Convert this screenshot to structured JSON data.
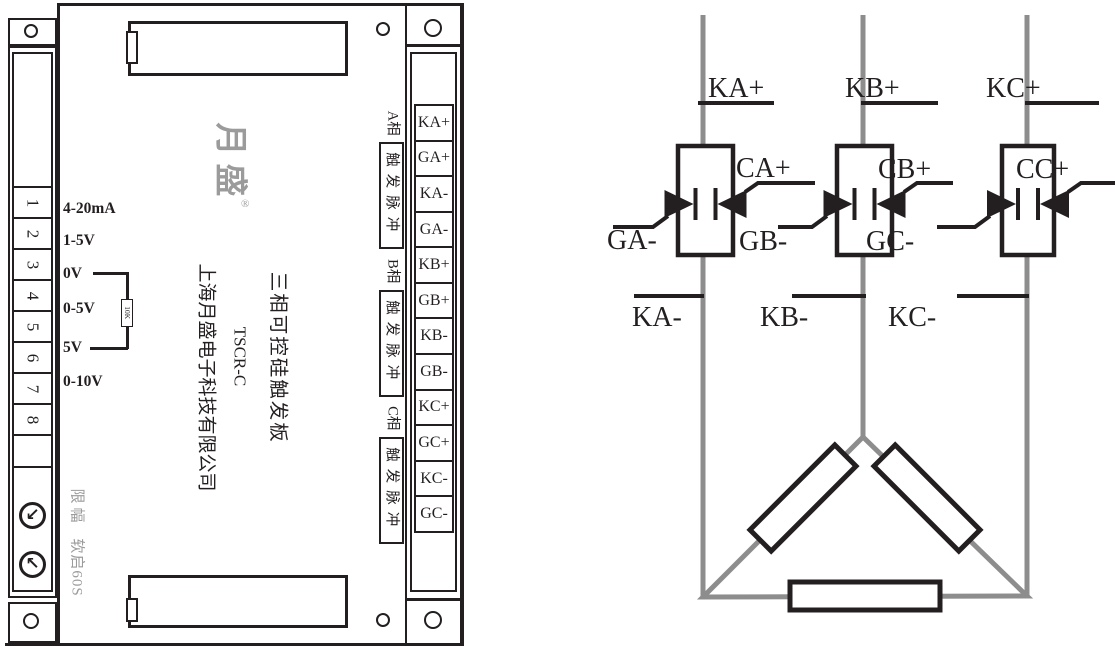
{
  "board": {
    "brand": {
      "logo": "月盛",
      "reg": "®"
    },
    "titles": {
      "product": "三相可控硅触发板",
      "model": "TSCR-C",
      "company": "上海月盛电子科技有限公司"
    },
    "left_terminals": [
      "1",
      "2",
      "3",
      "4",
      "5",
      "6",
      "7",
      "8"
    ],
    "input_labels": [
      "4-20mA",
      "1-5V",
      "0V",
      "0-5V",
      "5V",
      "0-10V"
    ],
    "resistor_value": "10K",
    "pot_labels": [
      "限幅",
      "软启60S"
    ],
    "pot_arrows": [
      "↙",
      "↖"
    ],
    "phases": [
      {
        "name": "A相",
        "pulse": "触发脉冲"
      },
      {
        "name": "B相",
        "pulse": "触发脉冲"
      },
      {
        "name": "C相",
        "pulse": "触发脉冲"
      }
    ],
    "right_terminals": [
      "KA+",
      "GA+",
      "KA-",
      "GA-",
      "KB+",
      "GB+",
      "KB-",
      "GB-",
      "KC+",
      "GC+",
      "KC-",
      "GC-"
    ]
  },
  "schematic": {
    "top_labels": [
      "KA+",
      "KB+",
      "KC+"
    ],
    "gate_plus_labels": [
      "CA+",
      "CB+",
      "CC+"
    ],
    "gate_minus_labels": [
      "GA-",
      "GB-",
      "GC-"
    ],
    "bottom_labels": [
      "KA-",
      "KB-",
      "KC-"
    ]
  },
  "colors": {
    "line": "#231f20",
    "wire": "#8d8d8d",
    "logo_gray": "#9b9b9b"
  }
}
